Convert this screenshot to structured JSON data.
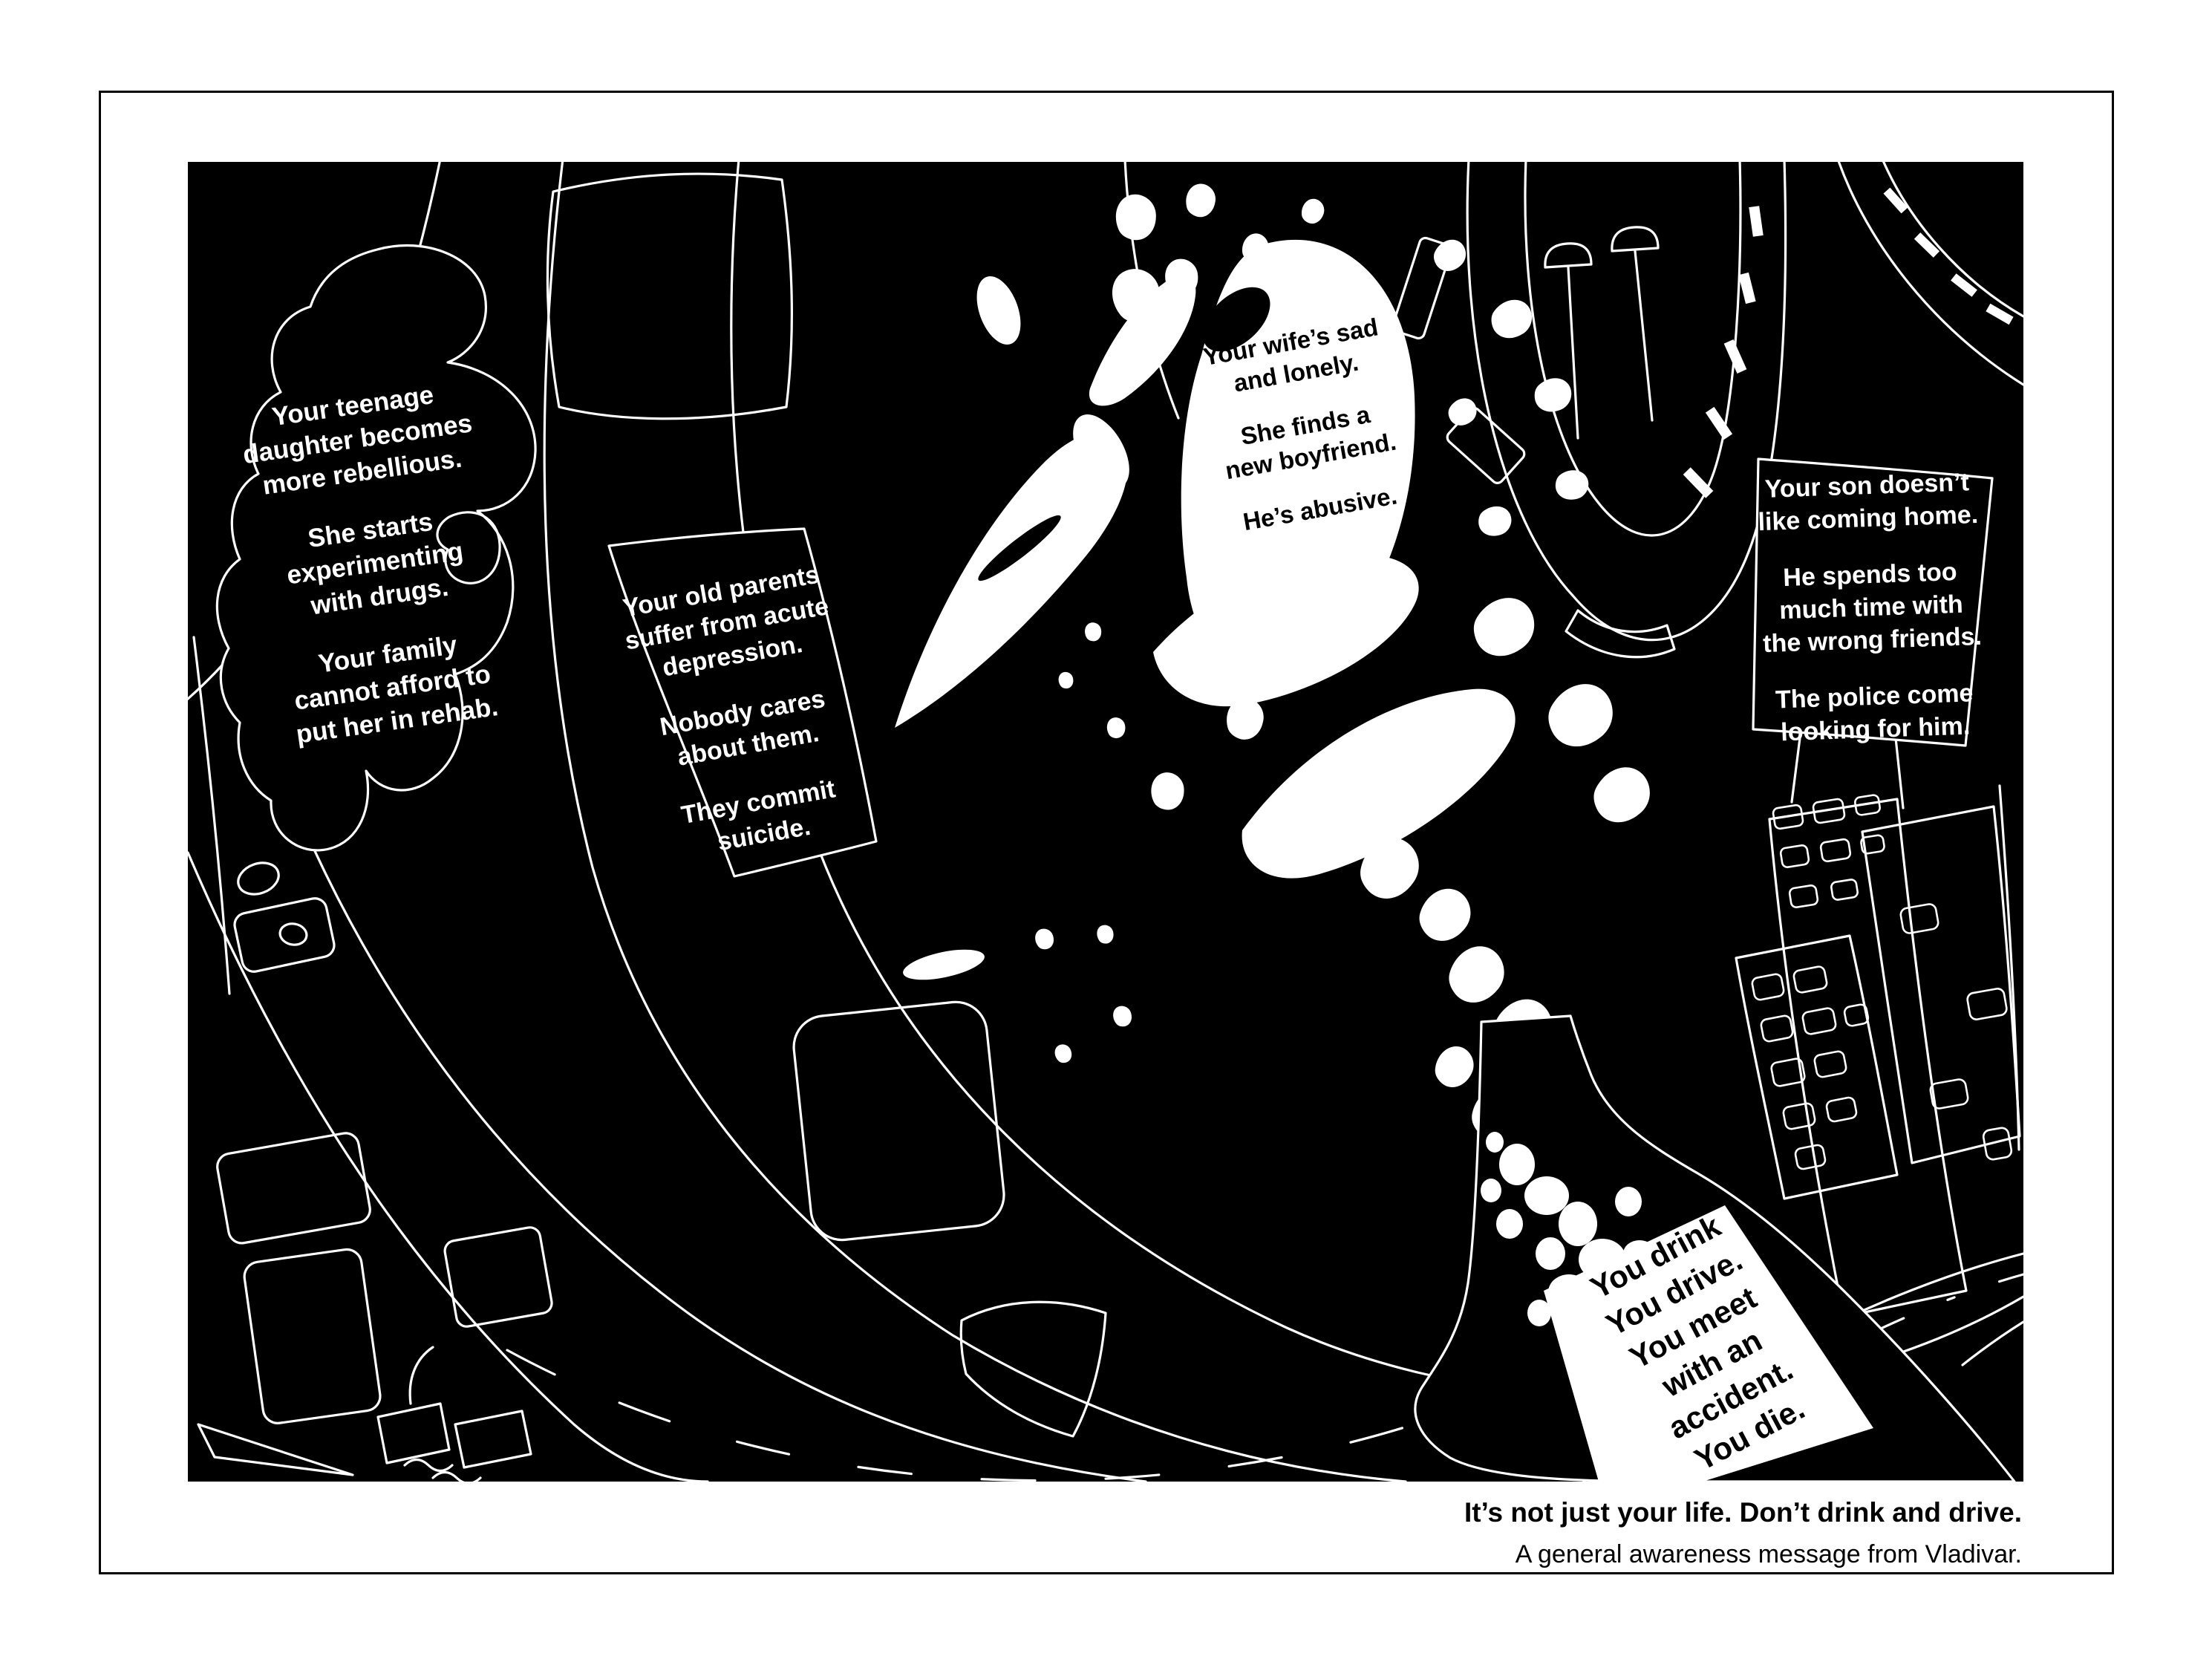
{
  "palette": {
    "paper": "#ffffff",
    "canvas": "#000000",
    "ink": "#ffffff",
    "text_on_white": "#000000"
  },
  "callouts": {
    "daughter": {
      "paragraphs": [
        [
          "Your teenage",
          "daughter becomes",
          "more rebellious."
        ],
        [
          "She starts",
          "experimenting",
          "with drugs."
        ],
        [
          "Your family",
          "cannot afford to",
          "put her in rehab."
        ]
      ]
    },
    "parents": {
      "paragraphs": [
        [
          "Your old parents",
          "suffer from acute",
          "depression."
        ],
        [
          "Nobody cares",
          "about them."
        ],
        [
          "They commit",
          "suicide."
        ]
      ]
    },
    "wife": {
      "paragraphs": [
        [
          "Your wife’s sad",
          "and lonely."
        ],
        [
          "She finds a",
          "new boyfriend."
        ],
        [
          "He’s abusive."
        ]
      ]
    },
    "son": {
      "paragraphs": [
        [
          "Your son doesn’t",
          "like coming home."
        ],
        [
          "He spends too",
          "much time with",
          "the wrong friends."
        ],
        [
          "The police come",
          "looking for him."
        ]
      ]
    },
    "bottle_label": {
      "lines": [
        "You drink",
        "You drive.",
        "You meet",
        "with an",
        "accident.",
        "You die."
      ]
    }
  },
  "footer": {
    "headline": "It’s not just your life. Don’t drink and drive.",
    "subline": "A general awareness message from Vladivar."
  }
}
